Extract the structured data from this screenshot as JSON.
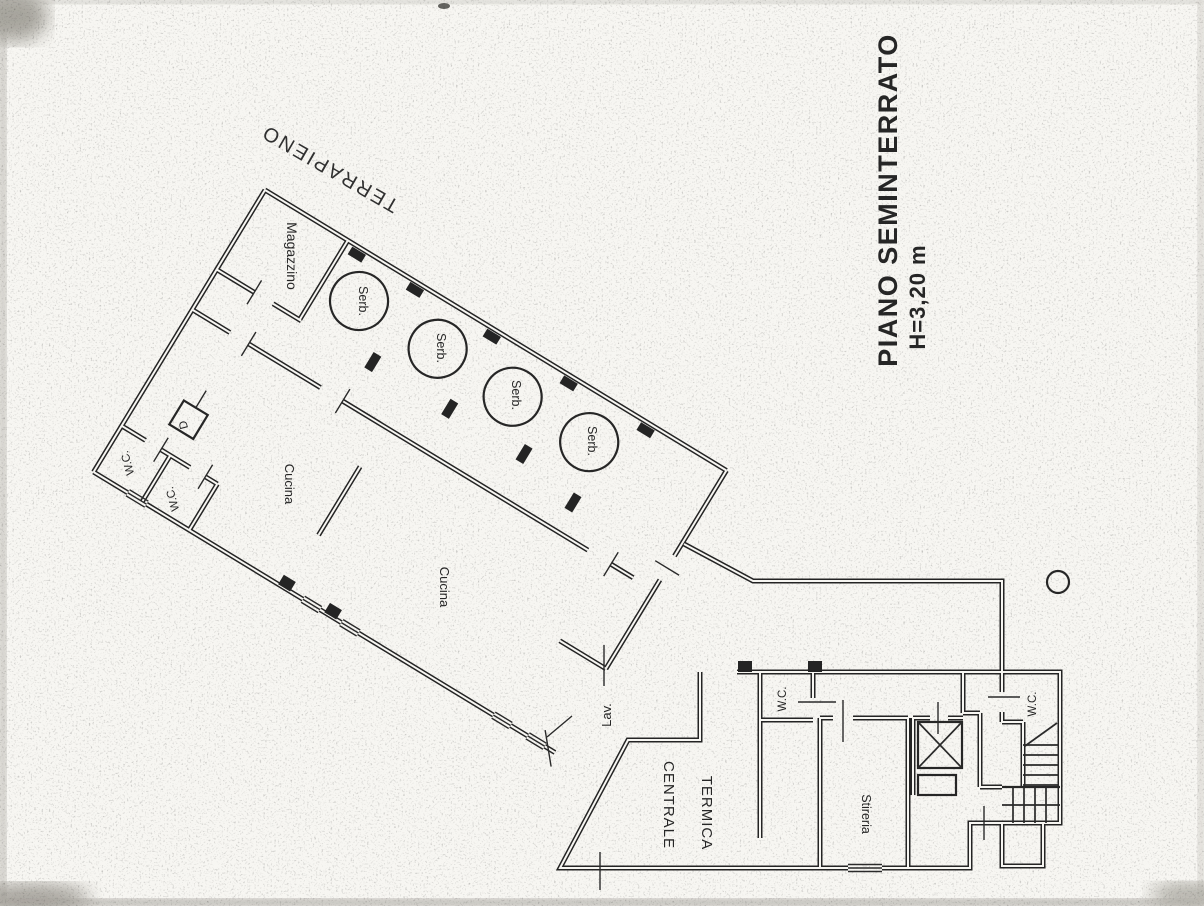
{
  "title": {
    "line1": "PIANO SEMINTERRATO",
    "line2": "H=3,20 m"
  },
  "labels": {
    "terrapieno": "TERRAPIENO",
    "magazzino": "Magazzino",
    "serb": "Serb.",
    "cucina": "Cucina",
    "wc": "W.C.",
    "d": "D",
    "lav": "Lav.",
    "centrale": "CENTRALE",
    "termica": "TERMICA",
    "stireria": "Stireria"
  },
  "colors": {
    "ink": "#242424",
    "paper": "#f7f6f2"
  }
}
